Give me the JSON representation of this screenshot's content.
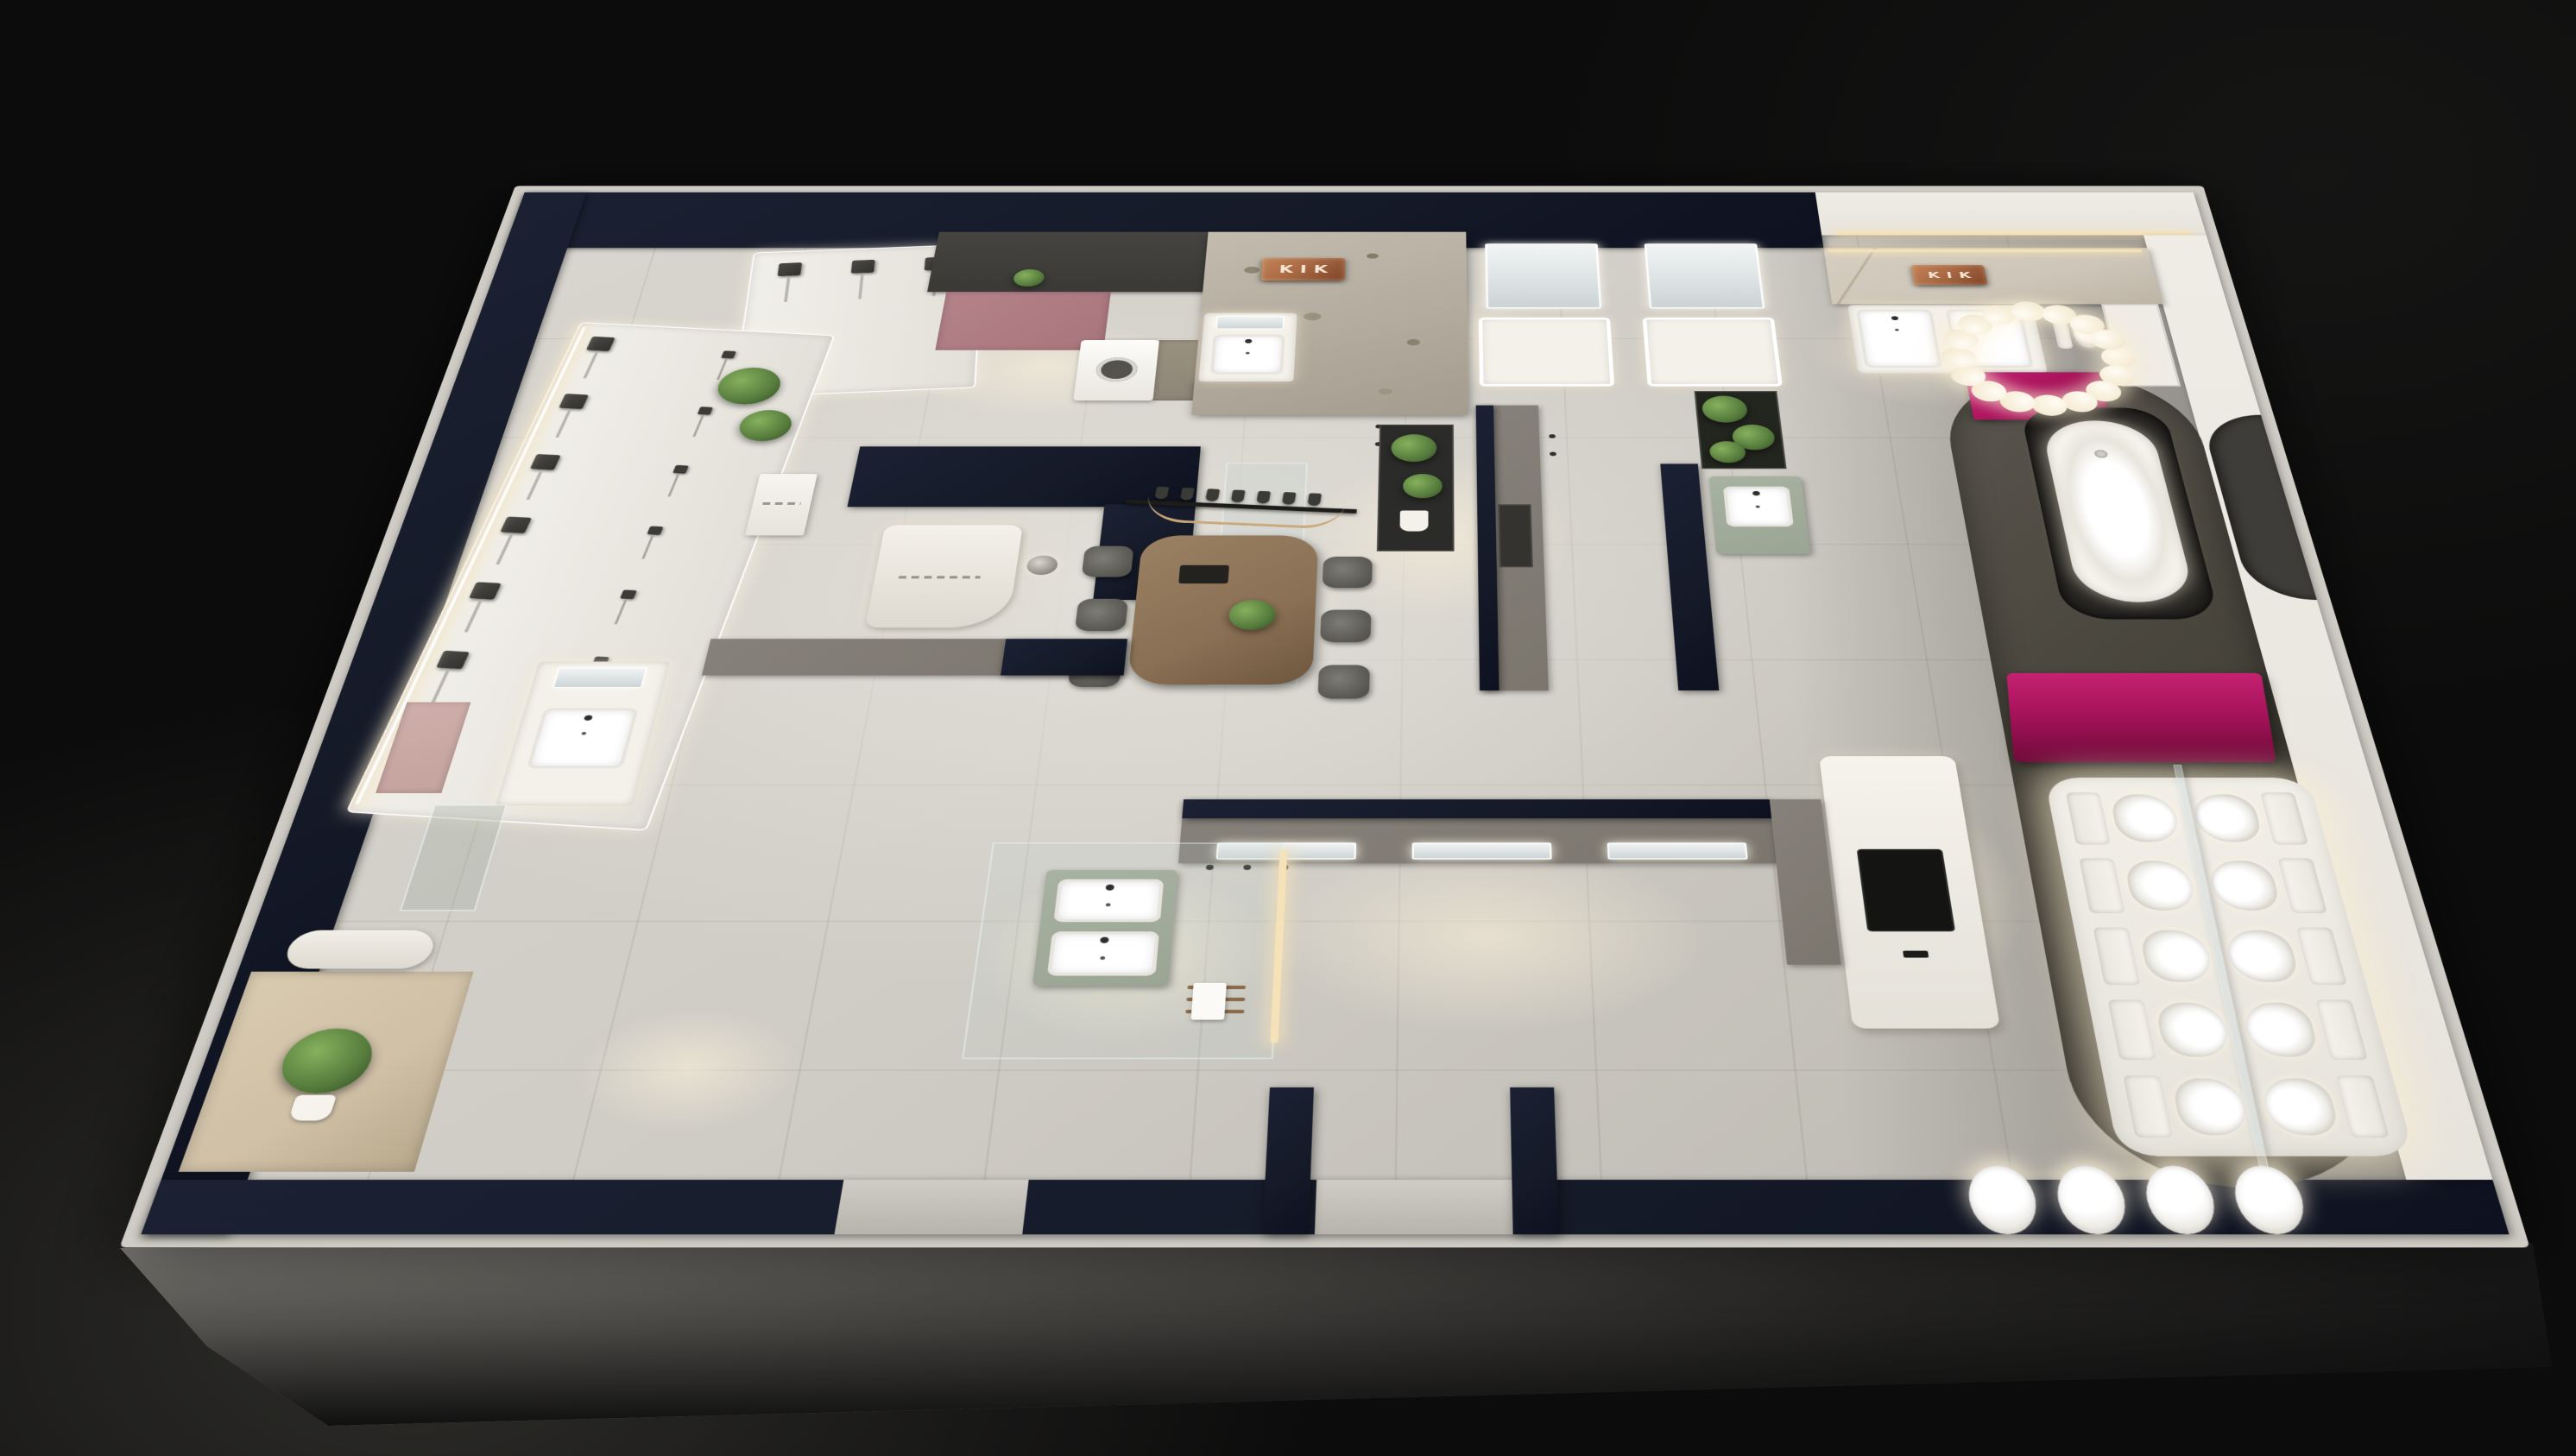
{
  "scene_type": "3d-isometric-bathroom-showroom-floorplan-render",
  "signs": {
    "stone_wall_sign": "KIK",
    "marble_wall_sign": "KIK"
  },
  "colors": {
    "background": "#0c0c0c",
    "background_glow": "#2a2927",
    "slab_rim": "#cfccc5",
    "floor": "#d6d3cc",
    "floor_dim": "#b7b4ac",
    "wall_navy": "#151a28",
    "wall_white": "#e7e4dd",
    "wall_gray": "#7b766e",
    "dark_zone": "#4b4843",
    "stone_wall": "#b3ab9e",
    "marble_wall": "#cdc5b8",
    "copper": "#a96a45",
    "pink_panel": "#a7757b",
    "blush_panel": "#c4a29e",
    "magenta": "#a8135b",
    "sage": "#9aa594",
    "wood": "#8a7054",
    "chair": "#6e6d68",
    "plant": "#557a3c",
    "plant_light": "#86b15d",
    "led_warm": "#f6e2b8",
    "glow": "#fff3dc",
    "fixture_white": "#f4f1ea",
    "charcoal": "#2c2b28",
    "glass": "#b9c6c4",
    "tv": "#141413",
    "pebble": "#262421",
    "taupe": "#8d8578",
    "counter_dark": "#3a3936",
    "slate": "#5e646b"
  },
  "fixtures": {
    "shower_heads": 7,
    "hand_showers": 7,
    "alcove_columns": 3,
    "chandelier_globes": 16,
    "toilets": 10,
    "wall_basins": 4,
    "dining_chairs_per_side": 3,
    "pendant_planters": 7,
    "trio_vanities": 3,
    "top_row_vanities": 2,
    "island_vanities_per_side": 2,
    "double_sink_basins": 2,
    "washing_machines": 1,
    "bathtubs": 1
  }
}
